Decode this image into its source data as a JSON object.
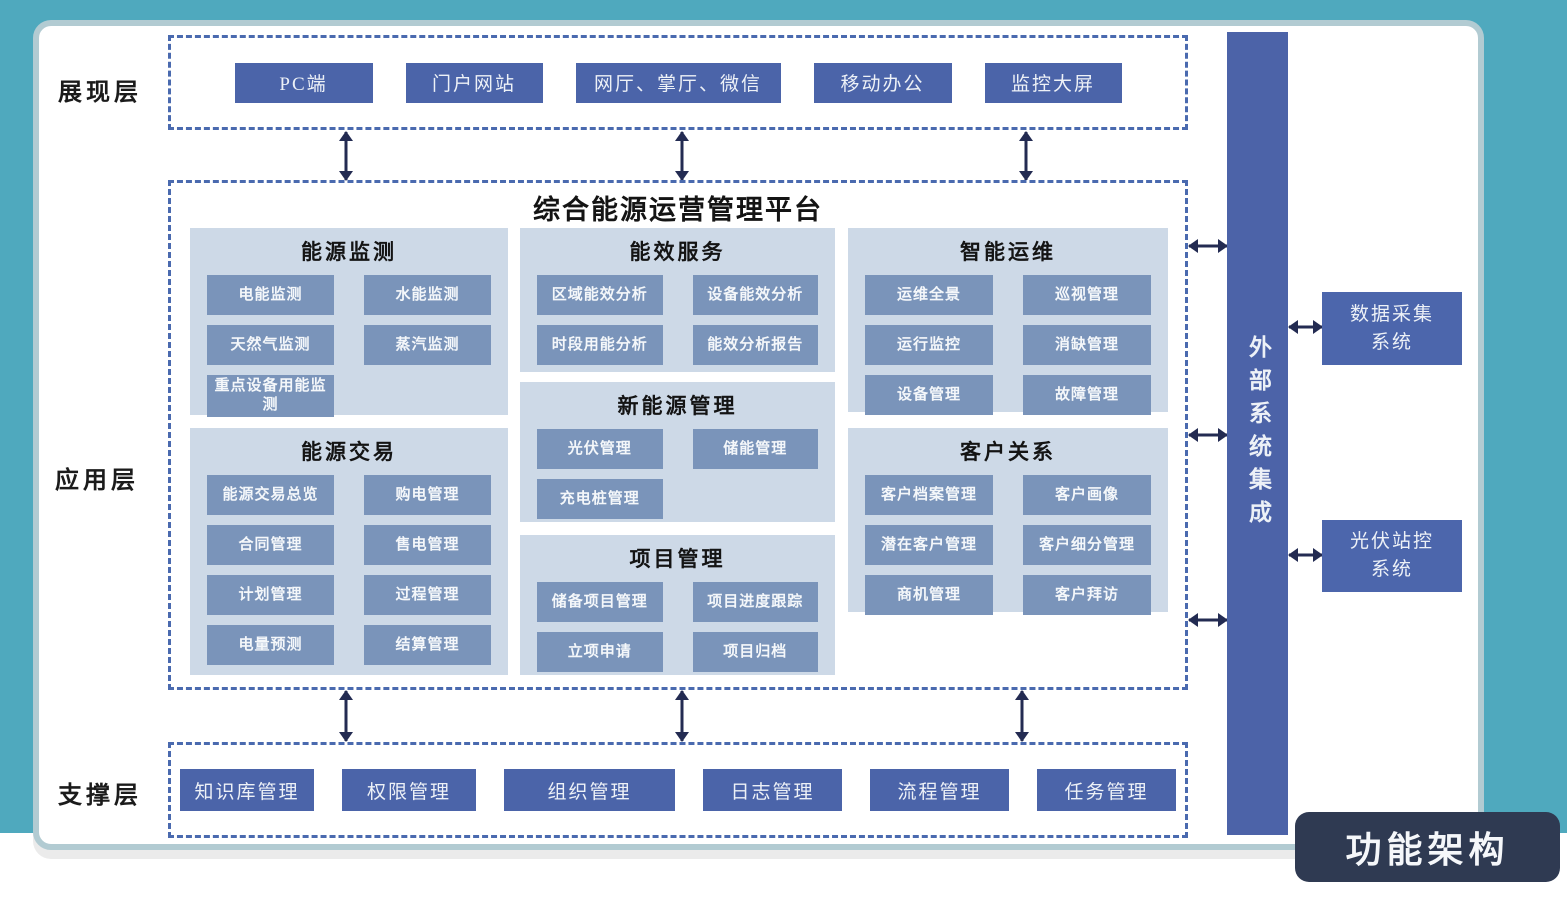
{
  "page": {
    "badge_label": "功能架构"
  },
  "platform": {
    "title": "综合能源运营管理平台"
  },
  "layers": {
    "presentation": {
      "label": "展现层",
      "items": [
        "PC端",
        "门户网站",
        "网厅、掌厅、微信",
        "移动办公",
        "监控大屏"
      ]
    },
    "application": {
      "label": "应用层",
      "groups": [
        {
          "title": "能源监测",
          "items": [
            "电能监测",
            "水能监测",
            "天然气监测",
            "蒸汽监测",
            "重点设备用能监测"
          ]
        },
        {
          "title": "能效服务",
          "items": [
            "区域能效分析",
            "设备能效分析",
            "时段用能分析",
            "能效分析报告"
          ]
        },
        {
          "title": "智能运维",
          "items": [
            "运维全景",
            "巡视管理",
            "运行监控",
            "消缺管理",
            "设备管理",
            "故障管理"
          ]
        },
        {
          "title": "能源交易",
          "items": [
            "能源交易总览",
            "购电管理",
            "合同管理",
            "售电管理",
            "计划管理",
            "过程管理",
            "电量预测",
            "结算管理"
          ]
        },
        {
          "title": "新能源管理",
          "items": [
            "光伏管理",
            "储能管理",
            "充电桩管理"
          ]
        },
        {
          "title": "客户关系",
          "items": [
            "客户档案管理",
            "客户画像",
            "潜在客户管理",
            "客户细分管理",
            "商机管理",
            "客户拜访"
          ]
        },
        {
          "title": "项目管理",
          "items": [
            "储备项目管理",
            "项目进度跟踪",
            "立项申请",
            "项目归档"
          ]
        }
      ]
    },
    "support": {
      "label": "支撑层",
      "items": [
        "知识库管理",
        "权限管理",
        "组织管理",
        "日志管理",
        "流程管理",
        "任务管理"
      ]
    }
  },
  "external": {
    "bar_label": "外部系统集成",
    "systems": [
      "数据采集系统",
      "光伏站控系统"
    ]
  },
  "colors": {
    "background_teal": "#4FA9BE",
    "indigo_box": "#4B64A9",
    "panel_bg": "#CDD9E7",
    "module_button": "#7A94BA",
    "dashed_border": "#4A6AAF",
    "arrow": "#232B52",
    "badge_bg": "#2F3A52"
  }
}
